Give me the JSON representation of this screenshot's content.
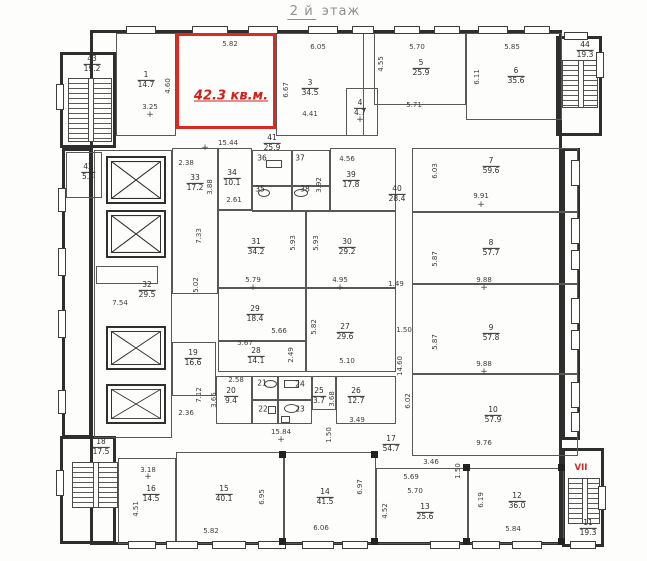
{
  "title": {
    "prefix": "2 й",
    "suffix": "этаж"
  },
  "highlighted_room": {
    "label": "42.3 кв.м.",
    "color": "#d92b24"
  },
  "stairwell_marker": "VII",
  "floor_plan": {
    "rooms": [
      {
        "num": "1",
        "area": "14.7",
        "x": 146,
        "y": 80
      },
      {
        "num": "3",
        "area": "34.5",
        "x": 310,
        "y": 88
      },
      {
        "num": "4",
        "area": "4.7",
        "x": 360,
        "y": 108
      },
      {
        "num": "5",
        "area": "25.9",
        "x": 421,
        "y": 68
      },
      {
        "num": "6",
        "area": "35.6",
        "x": 516,
        "y": 76
      },
      {
        "num": "7",
        "area": "59.6",
        "x": 491,
        "y": 166
      },
      {
        "num": "8",
        "area": "57.7",
        "x": 491,
        "y": 248
      },
      {
        "num": "9",
        "area": "57.8",
        "x": 491,
        "y": 333
      },
      {
        "num": "10",
        "area": "57.9",
        "x": 493,
        "y": 415
      },
      {
        "num": "11",
        "area": "19.3",
        "x": 588,
        "y": 528
      },
      {
        "num": "12",
        "area": "36.0",
        "x": 517,
        "y": 501
      },
      {
        "num": "13",
        "area": "25.6",
        "x": 425,
        "y": 512
      },
      {
        "num": "14",
        "area": "41.5",
        "x": 325,
        "y": 497
      },
      {
        "num": "15",
        "area": "40.1",
        "x": 224,
        "y": 494
      },
      {
        "num": "16",
        "area": "14.5",
        "x": 151,
        "y": 494
      },
      {
        "num": "17",
        "area": "54.7",
        "x": 391,
        "y": 444
      },
      {
        "num": "18",
        "area": "17.5",
        "x": 101,
        "y": 447
      },
      {
        "num": "19",
        "area": "16.6",
        "x": 193,
        "y": 358
      },
      {
        "num": "20",
        "area": "9.4",
        "x": 231,
        "y": 396
      },
      {
        "num": "21",
        "x": 262,
        "y": 384
      },
      {
        "num": "22",
        "x": 263,
        "y": 410
      },
      {
        "num": "23",
        "x": 300,
        "y": 410
      },
      {
        "num": "24",
        "x": 300,
        "y": 385
      },
      {
        "num": "25",
        "area": "3.7",
        "x": 319,
        "y": 396
      },
      {
        "num": "26",
        "area": "12.7",
        "x": 356,
        "y": 396
      },
      {
        "num": "27",
        "area": "29.6",
        "x": 345,
        "y": 332
      },
      {
        "num": "28",
        "area": "14.1",
        "x": 256,
        "y": 356
      },
      {
        "num": "29",
        "area": "18.4",
        "x": 255,
        "y": 314
      },
      {
        "num": "30",
        "area": "29.2",
        "x": 347,
        "y": 247
      },
      {
        "num": "31",
        "area": "34.2",
        "x": 256,
        "y": 247
      },
      {
        "num": "32",
        "area": "29.5",
        "x": 147,
        "y": 290
      },
      {
        "num": "33",
        "area": "17.2",
        "x": 195,
        "y": 183
      },
      {
        "num": "34",
        "area": "10.1",
        "x": 232,
        "y": 178
      },
      {
        "num": "35",
        "x": 260,
        "y": 190
      },
      {
        "num": "36",
        "x": 262,
        "y": 159
      },
      {
        "num": "37",
        "x": 300,
        "y": 159
      },
      {
        "num": "38",
        "x": 305,
        "y": 190
      },
      {
        "num": "39",
        "area": "17.8",
        "x": 351,
        "y": 180
      },
      {
        "num": "40",
        "area": "28.4",
        "x": 397,
        "y": 194
      },
      {
        "num": "41",
        "area": "25.9",
        "x": 272,
        "y": 143
      },
      {
        "num": "42",
        "area": "5.8",
        "x": 88,
        "y": 172
      },
      {
        "num": "43",
        "area": "19.2",
        "x": 92,
        "y": 64
      },
      {
        "num": "44",
        "area": "19.3",
        "x": 585,
        "y": 50
      }
    ],
    "dims": [
      {
        "t": "5.82",
        "x": 230,
        "y": 44
      },
      {
        "t": "6.05",
        "x": 318,
        "y": 47
      },
      {
        "t": "5.70",
        "x": 417,
        "y": 47
      },
      {
        "t": "5.85",
        "x": 512,
        "y": 47
      },
      {
        "t": "4.60",
        "x": 168,
        "y": 86,
        "v": 1
      },
      {
        "t": "3.25",
        "x": 150,
        "y": 107
      },
      {
        "t": "6.67",
        "x": 286,
        "y": 90,
        "v": 1
      },
      {
        "t": "4.55",
        "x": 381,
        "y": 64,
        "v": 1
      },
      {
        "t": "6.11",
        "x": 477,
        "y": 77,
        "v": 1
      },
      {
        "t": "4.41",
        "x": 310,
        "y": 114
      },
      {
        "t": "5.71",
        "x": 414,
        "y": 105
      },
      {
        "t": "15.44",
        "x": 228,
        "y": 143
      },
      {
        "t": "2.38",
        "x": 186,
        "y": 163
      },
      {
        "t": "3.88",
        "x": 210,
        "y": 187,
        "v": 1
      },
      {
        "t": "2.61",
        "x": 234,
        "y": 200
      },
      {
        "t": "4.56",
        "x": 347,
        "y": 159
      },
      {
        "t": "3.92",
        "x": 319,
        "y": 185,
        "v": 1
      },
      {
        "t": "7.33",
        "x": 199,
        "y": 236,
        "v": 1
      },
      {
        "t": "5.02",
        "x": 196,
        "y": 285,
        "v": 1
      },
      {
        "t": "7.54",
        "x": 120,
        "y": 303
      },
      {
        "t": "5.93",
        "x": 293,
        "y": 243,
        "v": 1
      },
      {
        "t": "5.93",
        "x": 316,
        "y": 243,
        "v": 1
      },
      {
        "t": "6.03",
        "x": 435,
        "y": 171,
        "v": 1
      },
      {
        "t": "9.91",
        "x": 481,
        "y": 196
      },
      {
        "t": "5.87",
        "x": 435,
        "y": 259,
        "v": 1
      },
      {
        "t": "9.88",
        "x": 484,
        "y": 280
      },
      {
        "t": "5.87",
        "x": 435,
        "y": 342,
        "v": 1
      },
      {
        "t": "9.88",
        "x": 484,
        "y": 364
      },
      {
        "t": "1.49",
        "x": 396,
        "y": 284
      },
      {
        "t": "1.50",
        "x": 404,
        "y": 330
      },
      {
        "t": "14.60",
        "x": 400,
        "y": 366,
        "v": 1
      },
      {
        "t": "6.02",
        "x": 408,
        "y": 401,
        "v": 1
      },
      {
        "t": "9.76",
        "x": 484,
        "y": 443
      },
      {
        "t": "5.79",
        "x": 253,
        "y": 280
      },
      {
        "t": "4.95",
        "x": 340,
        "y": 280
      },
      {
        "t": "5.66",
        "x": 279,
        "y": 331
      },
      {
        "t": "5.67",
        "x": 245,
        "y": 343
      },
      {
        "t": "2.49",
        "x": 291,
        "y": 355,
        "v": 1
      },
      {
        "t": "5.82",
        "x": 314,
        "y": 327,
        "v": 1
      },
      {
        "t": "5.10",
        "x": 347,
        "y": 361
      },
      {
        "t": "2.58",
        "x": 236,
        "y": 380
      },
      {
        "t": "3.65",
        "x": 214,
        "y": 400,
        "v": 1
      },
      {
        "t": "7.12",
        "x": 199,
        "y": 395,
        "v": 1
      },
      {
        "t": "2.36",
        "x": 186,
        "y": 413
      },
      {
        "t": "3.68",
        "x": 332,
        "y": 399,
        "v": 1
      },
      {
        "t": "3.49",
        "x": 357,
        "y": 420
      },
      {
        "t": "15.84",
        "x": 281,
        "y": 432
      },
      {
        "t": "1.50",
        "x": 329,
        "y": 435,
        "v": 1
      },
      {
        "t": "3.18",
        "x": 148,
        "y": 470
      },
      {
        "t": "4.51",
        "x": 136,
        "y": 509,
        "v": 1
      },
      {
        "t": "5.82",
        "x": 211,
        "y": 531
      },
      {
        "t": "6.95",
        "x": 262,
        "y": 497,
        "v": 1
      },
      {
        "t": "6.97",
        "x": 360,
        "y": 487,
        "v": 1
      },
      {
        "t": "6.06",
        "x": 321,
        "y": 528
      },
      {
        "t": "5.69",
        "x": 411,
        "y": 477
      },
      {
        "t": "5.70",
        "x": 415,
        "y": 491
      },
      {
        "t": "4.52",
        "x": 385,
        "y": 511,
        "v": 1
      },
      {
        "t": "6.19",
        "x": 481,
        "y": 500,
        "v": 1
      },
      {
        "t": "5.84",
        "x": 513,
        "y": 529
      },
      {
        "t": "3.46",
        "x": 431,
        "y": 462
      },
      {
        "t": "1.50",
        "x": 458,
        "y": 471,
        "v": 1
      }
    ]
  }
}
